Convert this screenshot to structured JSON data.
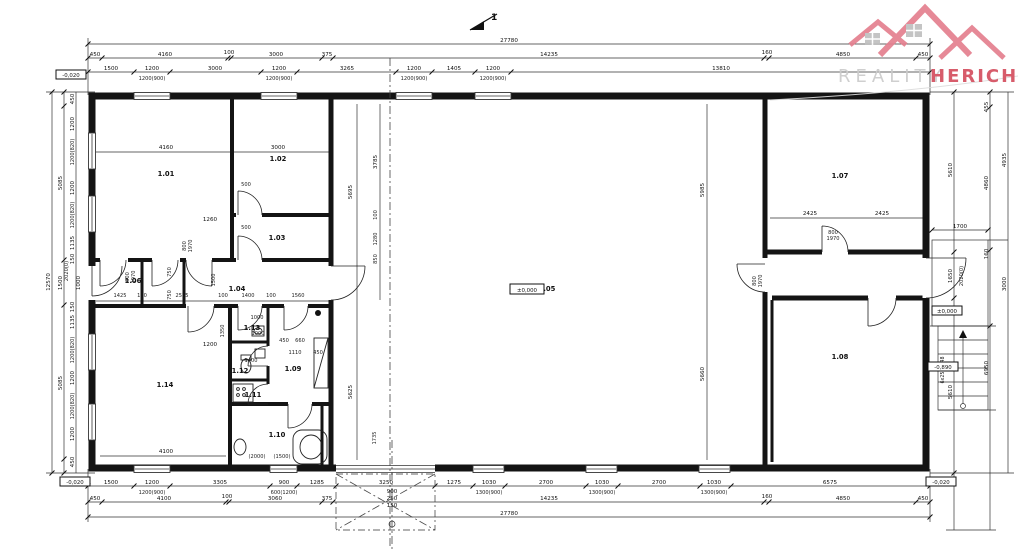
{
  "logo": {
    "word1": "REALITY",
    "word2": "HERICH",
    "pink": "#e4808f",
    "red": "#d44f5f",
    "gray": "#cbcbcb"
  },
  "section_marker": "1",
  "rooms": {
    "r101": "1.01",
    "r102": "1.02",
    "r103": "1.03",
    "r104": "1.04",
    "r105": "1.05",
    "r106": "1.06",
    "r107": "1.07",
    "r108": "1.08",
    "r109": "1.09",
    "r110": "1.10",
    "r111": "1.11",
    "r112": "1.12",
    "r113": "1.13",
    "r114": "1.14"
  },
  "elevations": {
    "top_left": "-0,020",
    "hall": "±0,000",
    "right_top": "±0,000",
    "right_bottom": "-0,890",
    "bottom_left": "-0,020",
    "bottom_right": "-0,020"
  },
  "stairs_label": "6x250x148",
  "dims": {
    "top_total": "27780",
    "top2": [
      "450",
      "4160",
      "100",
      "3000",
      "375",
      "14235",
      "160",
      "4850",
      "450"
    ],
    "top3": [
      "1500",
      "1200",
      "3000",
      "1200",
      "3265",
      "1200",
      "1405",
      "1200",
      "13810"
    ],
    "top3_sub": [
      "1200(900)",
      "1200(900)",
      "1200(900)",
      "1200(900)"
    ],
    "bot1": [
      "1500",
      "1200",
      "3305",
      "900",
      "1285",
      "3250",
      "1275",
      "1030",
      "2700",
      "1030",
      "2700",
      "1030",
      "6575"
    ],
    "bot1_sub": [
      "1200(900)",
      "600(1200)",
      "1300(900)",
      "1300(900)",
      "1300(900)"
    ],
    "bot2": [
      "450",
      "4100",
      "100",
      "3060",
      "375",
      "14235",
      "160",
      "4850",
      "450"
    ],
    "bot_total": "27780",
    "left_outer": "12570",
    "left_mid": [
      "5085",
      "1500",
      "5085"
    ],
    "left_inner": [
      "450",
      "1200",
      "1200(820)",
      "1200",
      "1200(820)",
      "1135",
      "150",
      "2020(0)",
      "1000",
      "150",
      "1135",
      "1200(820)",
      "1200",
      "1200(820)",
      "1200",
      "450"
    ],
    "right_inner": [
      "5610",
      "1650",
      "5610"
    ],
    "right_mid": [
      "455",
      "4860",
      "160",
      "6950"
    ],
    "right_outer": [
      "4935",
      "3000"
    ],
    "right_landing": "1700",
    "right_door": "2020(0)",
    "porch": [
      "900",
      "250",
      "150"
    ],
    "door_w": "800",
    "door_h": "1970",
    "interior": [
      "4160",
      "3000",
      "1260",
      "500",
      "500",
      "1200",
      "1350",
      "5695",
      "3785",
      "100",
      "1280",
      "850",
      "5625",
      "1735",
      "1425",
      "100",
      "2575",
      "100",
      "1400",
      "100",
      "1560",
      "750",
      "750",
      "1500",
      "1000",
      "1000",
      "450",
      "660",
      "1110",
      "450",
      "1400",
      "2425",
      "2425",
      "5985",
      "5660",
      "(2000)",
      "(1500)",
      "4100"
    ]
  }
}
